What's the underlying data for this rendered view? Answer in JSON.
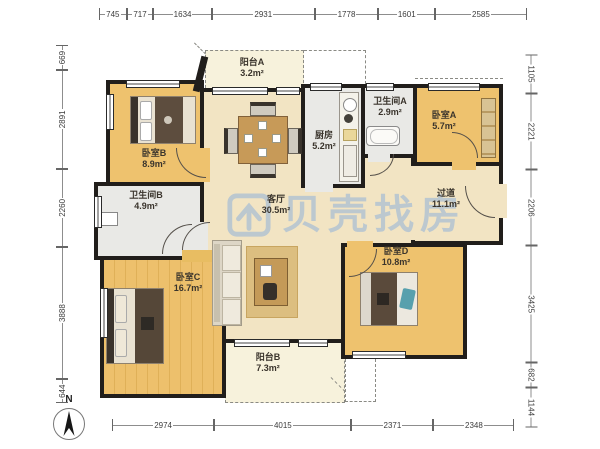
{
  "watermark": {
    "text": "贝壳找房"
  },
  "compass": {
    "label": "N"
  },
  "rooms": {
    "balcony_a": {
      "name": "阳台A",
      "area": "3.2m²"
    },
    "bedroom_b": {
      "name": "卧室B",
      "area": "8.9m²"
    },
    "bathroom_b": {
      "name": "卫生间B",
      "area": "4.9m²"
    },
    "bedroom_c": {
      "name": "卧室C",
      "area": "16.7m²"
    },
    "living": {
      "name": "客厅",
      "area": "30.5m²"
    },
    "kitchen": {
      "name": "厨房",
      "area": "5.2m²"
    },
    "bathroom_a": {
      "name": "卫生间A",
      "area": "2.9m²"
    },
    "bedroom_a": {
      "name": "卧室A",
      "area": "5.7m²"
    },
    "hallway": {
      "name": "过道",
      "area": "11.1m²"
    },
    "bedroom_d": {
      "name": "卧室D",
      "area": "10.8m²"
    },
    "balcony_b": {
      "name": "阳台B",
      "area": "7.3m²"
    }
  },
  "dimensions": {
    "top": [
      "745",
      "717",
      "1634",
      "2931",
      "1778",
      "1601",
      "2585"
    ],
    "bottom": [
      "2974",
      "4015",
      "2371",
      "2348"
    ],
    "left": [
      "669",
      "2891",
      "2260",
      "3888",
      "644"
    ],
    "right": [
      "1105",
      "2221",
      "2206",
      "3425",
      "682",
      "1144"
    ]
  },
  "colors": {
    "wall": "#211e1b",
    "wood_floor": "#eec26e",
    "living_floor": "#f2e4c3",
    "wet_floor": "#e9e9e6",
    "balcony_floor": "#f7f2dc",
    "watermark": "#aabfd4"
  }
}
